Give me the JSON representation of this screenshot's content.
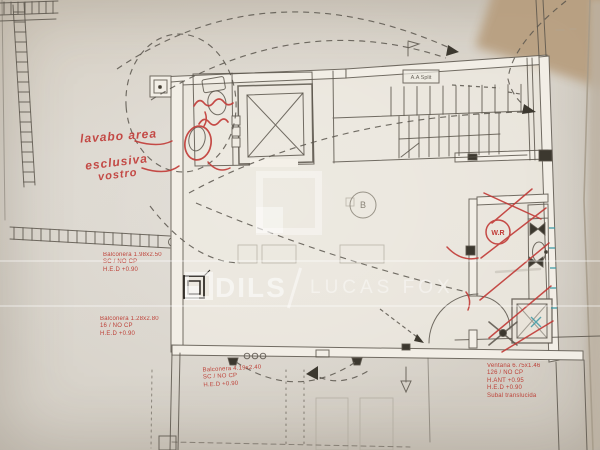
{
  "document": {
    "type": "photographed architectural floor plan",
    "colors": {
      "paper": "#d8d3ca",
      "ink": "#5b554b",
      "red": "#bc3a31",
      "cyan": "#3f9aa5",
      "watermark": "#ffffff"
    }
  },
  "watermark": {
    "brand_left": "DILS",
    "separator": "/",
    "brand_right": "LUCAS FOX"
  },
  "plan": {
    "aa_split_label": "A.A Split",
    "stair_letter": "B",
    "wr_label": "W.R",
    "printed_notes": [
      {
        "id": "balcony-note-1",
        "lines": [
          "Balconera 1.98x2.50",
          "SC / NO CP",
          "H.E.D +0.90"
        ]
      },
      {
        "id": "balcony-note-2",
        "lines": [
          "Balconera 1.28x2.80",
          "16 / NO CP",
          "H.E.D +0.90"
        ]
      },
      {
        "id": "balcony-note-3",
        "lines": [
          "Balconera 4.19x2.40",
          "SC / NO CP",
          "H.E.D +0.90"
        ]
      },
      {
        "id": "window-note",
        "lines": [
          "Ventana 6.75x1.46",
          "126 / NO CP",
          "H.ANT +0.95",
          "H.E.D +0.90",
          "Subal translucida"
        ]
      }
    ],
    "handwritten_notes": {
      "note_a": "lavabo area",
      "note_b": "esclusiva",
      "note_c": "vostro"
    }
  }
}
